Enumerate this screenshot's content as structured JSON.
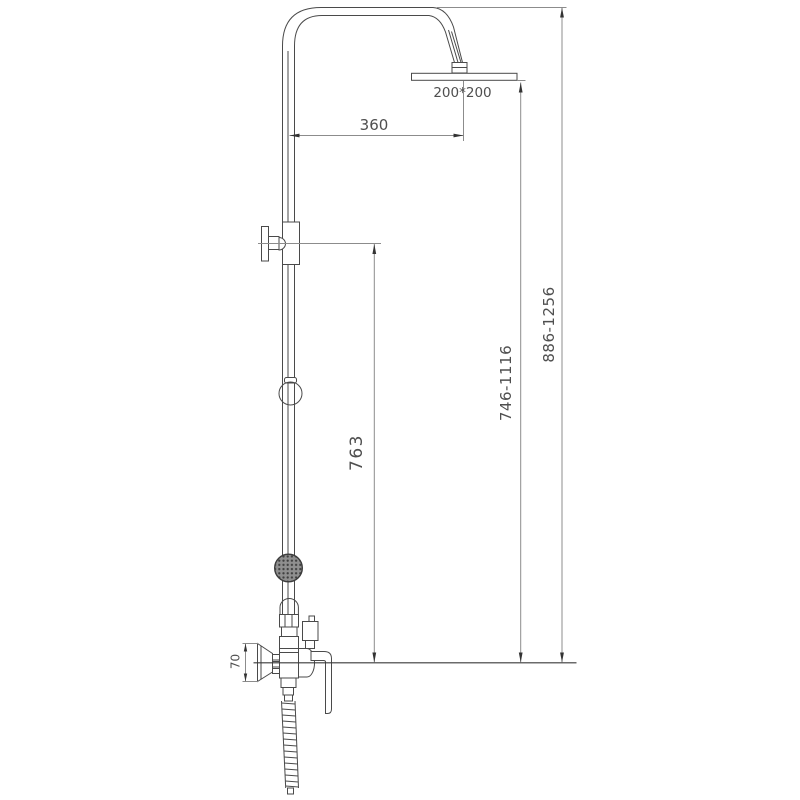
{
  "drawing": {
    "type": "shower-column-technical-drawing",
    "dimensions": {
      "overhead_shower_size": "200*200",
      "arm_projection": "360",
      "bracket_to_outlet_height": "763",
      "riser_height_range": "746-1116",
      "overall_height_range": "886-1256",
      "escutcheon_height": "70"
    },
    "colors": {
      "line": "#4a4a4a",
      "dimension_line": "#8c8c8c",
      "text": "#4f4f4f",
      "background": "#ffffff"
    }
  }
}
